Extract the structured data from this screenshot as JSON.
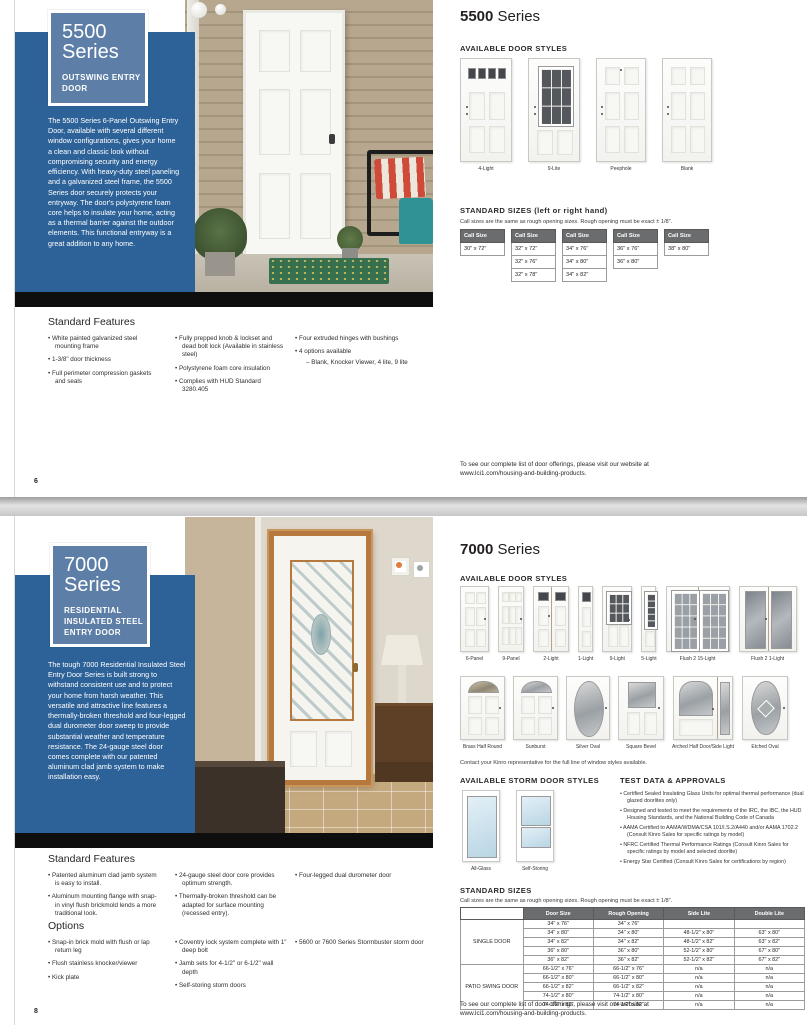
{
  "shared": {
    "footer_line1": "To see our complete list of door offerings, please visit our website at",
    "footer_line2": "www.lci1.com/housing-and-building-products.",
    "call_size_header": "Call Size",
    "colors": {
      "panel_blue": "#2d6298",
      "badge_blue": "#5d7fa7",
      "table_header_gray": "#6b6c6e",
      "bar_black": "#0e0e0e"
    }
  },
  "page1": {
    "page_number": "6",
    "badge": {
      "number": "5500",
      "word": "Series",
      "subtitle": "OUTSWING ENTRY DOOR"
    },
    "intro_text": "The 5500 Series 6-Panel Outswing Entry Door, available with several different window configurations, gives your home a clean and classic look without compromising security and energy efficiency. With heavy-duty steel paneling and a galvanized steel frame, the 5500 Series door securely protects your entryway. The door's polystyrene foam core helps to insulate your home, acting as a thermal barrier against the outdoor elements. This functional entryway is a great addition to any home.",
    "title_bold": "5500",
    "title_word": " Series",
    "door_styles_heading": "AVAILABLE DOOR STYLES",
    "door_styles": [
      {
        "label": "4-Light",
        "kind": "light4"
      },
      {
        "label": "9-Lite",
        "kind": "lite9"
      },
      {
        "label": "Peephole",
        "kind": "peephole"
      },
      {
        "label": "Blank",
        "kind": "blank"
      }
    ],
    "sizes_heading": "STANDARD SIZES (left or right hand)",
    "sizes_note": "Call sizes are the same as rough opening sizes. Rough opening must be exact ± 1/8\".",
    "call_size_tables": [
      {
        "rows": [
          "30\" x 72\""
        ]
      },
      {
        "rows": [
          "32\" x 72\"",
          "32\" x 76\"",
          "32\" x 78\""
        ]
      },
      {
        "rows": [
          "34\" x 76\"",
          "34\" x 80\"",
          "34\" x 82\""
        ]
      },
      {
        "rows": [
          "36\" x 76\"",
          "36\" x 80\""
        ]
      },
      {
        "rows": [
          "38\" x 80\""
        ]
      }
    ],
    "features": {
      "heading": "Standard Features",
      "columns": [
        [
          {
            "text": "White painted galvanized steel mounting frame"
          },
          {
            "text": "1-3/8\" door thickness"
          },
          {
            "text": "Full perimeter compression gaskets and seals"
          }
        ],
        [
          {
            "text": "Fully prepped knob & lockset and dead bolt lock (Available in stainless steel)"
          },
          {
            "text": "Polystyrene foam core insulation"
          },
          {
            "text": "Complies with HUD Standard 3280.405"
          }
        ],
        [
          {
            "text": "Four extruded hinges with bushings"
          },
          {
            "text": "4 options available"
          },
          {
            "text": "Blank, Knocker Viewer, 4 lite, 9 lite",
            "sub": true
          }
        ]
      ]
    }
  },
  "page2": {
    "page_number": "8",
    "badge": {
      "number": "7000",
      "word": "Series",
      "subtitle": "RESIDENTIAL INSULATED STEEL ENTRY DOOR"
    },
    "intro_text": "The tough 7000 Residential Insulated Steel Entry Door Series is built strong to withstand consistent use and to protect your home from harsh weather. This versatile and attractive line features a thermally-broken threshold and four-legged dual durometer door sweep to provide substantial weather and temperature resistance. The 24-gauge steel door comes complete with our patented aluminum clad jamb system to make installation easy.",
    "title_bold": "7000",
    "title_word": " Series",
    "door_styles_heading": "AVAILABLE DOOR STYLES",
    "door_styles_row1": [
      {
        "label": "6-Panel",
        "kind": "p6"
      },
      {
        "label": "9-Panel",
        "kind": "p9"
      },
      {
        "label": "2-Light",
        "kind": "light2"
      },
      {
        "label": "1-Light",
        "kind": "light1"
      },
      {
        "label": "9-Light",
        "kind": "light9"
      },
      {
        "label": "5-Light",
        "kind": "light5"
      },
      {
        "label": "Flush 2 15-Light",
        "kind": "flush15"
      },
      {
        "label": "Flush 2 1-Light",
        "kind": "flush1"
      }
    ],
    "door_styles_row2": [
      {
        "label": "Brass Half Round",
        "kind": "halfround"
      },
      {
        "label": "Sunburst",
        "kind": "sunburst"
      },
      {
        "label": "Silver Oval",
        "kind": "ovalsilver"
      },
      {
        "label": "Square Bevel",
        "kind": "squarebevel"
      },
      {
        "label": "Arched Half Door/Side Light",
        "kind": "archedhalf"
      },
      {
        "label": "Etched Oval",
        "kind": "etchedoval"
      }
    ],
    "styles_note": "Contact your Kinro representative for the full line of window styles available.",
    "storm_heading": "AVAILABLE STORM DOOR STYLES",
    "storm_styles": [
      {
        "label": "All-Glass",
        "kind": "allglass"
      },
      {
        "label": "Self-Storing",
        "kind": "selfstoring"
      }
    ],
    "test_data": {
      "heading": "TEST DATA & APPROVALS",
      "bullets": [
        "Certified Sealed Insulating Glass Units for optimal thermal performance (dual glazed doorlites only)",
        "Designed and tested to meet the requirements of the IRC, the IBC, the HUD Housing Standards, and the National Building Code of Canada",
        "AAMA Certified to AAMA/WDMA/CSA 101/I.S.2/A440 and/or AAMA 1702.2 (Consult Kinro Sales for specific ratings by model)",
        "NFRC Certified Thermal Performance Ratings (Consult Kinro Sales for specific ratings by model and selected doorlite)",
        "Energy Star Certified (Consult Kinro Sales for certifications by region)"
      ]
    },
    "sizes_heading": "STANDARD SIZES",
    "sizes_note": "Call sizes are the same as rough opening sizes. Rough opening must be exact ± 1/8\".",
    "sizes_table": {
      "columns": [
        "Door Size",
        "Rough Opening",
        "Side Lite",
        "Double Lite"
      ],
      "groups": [
        {
          "label": "SINGLE DOOR",
          "rows": [
            [
              "34\" x 76\"",
              "34\" x 76\"",
              "",
              ""
            ],
            [
              "34\" x 80\"",
              "34\" x 80\"",
              "48-1/2\" x 80\"",
              "63\" x 80\""
            ],
            [
              "34\" x 82\"",
              "34\" x 82\"",
              "48-1/2\" x 82\"",
              "63\" x 82\""
            ],
            [
              "36\" x 80\"",
              "36\" x 80\"",
              "52-1/2\" x 80\"",
              "67\" x 80\""
            ],
            [
              "36\" x 82\"",
              "36\" x 82\"",
              "52-1/2\" x 82\"",
              "67\" x 82\""
            ]
          ]
        },
        {
          "label": "PATIO SWING DOOR",
          "rows": [
            [
              "66-1/2\" x 76\"",
              "66-1/2\" x 76\"",
              "n/a",
              "n/a"
            ],
            [
              "66-1/2\" x 80\"",
              "66-1/2\" x 80\"",
              "n/a",
              "n/a"
            ],
            [
              "66-1/2\" x 82\"",
              "66-1/2\" x 82\"",
              "n/a",
              "n/a"
            ],
            [
              "74-1/2\" x 80\"",
              "74-1/2\" x 80\"",
              "n/a",
              "n/a"
            ],
            [
              "74-1/2\" x 82\"",
              "74-1/2\" x 82\"",
              "n/a",
              "n/a"
            ]
          ]
        }
      ]
    },
    "features": {
      "heading": "Standard Features",
      "columns": [
        [
          {
            "text": "Patented aluminum clad jamb system is easy to install."
          },
          {
            "text": "Aluminum mounting flange with snap-in vinyl flush brickmold lends a more traditional look."
          }
        ],
        [
          {
            "text": "24-gauge steel door core provides optimum strength."
          },
          {
            "text": "Thermally-broken threshold can be adapted for surface mounting (recessed entry)."
          }
        ],
        [
          {
            "text": "Four-legged dual durometer door"
          }
        ]
      ]
    },
    "options": {
      "heading": "Options",
      "columns": [
        [
          {
            "text": "Snap-in brick mold with flush or lap return leg"
          },
          {
            "text": "Flush stainless knocker/viewer"
          },
          {
            "text": "Kick plate"
          }
        ],
        [
          {
            "text": "Coventry lock system complete with 1\" deep bolt"
          },
          {
            "text": "Jamb sets for 4-1/2\" or 6-1/2\" wall depth"
          },
          {
            "text": "Self-storing storm doors"
          }
        ],
        [
          {
            "text": "5600 or 7600 Series Stormbuster storm door"
          }
        ]
      ]
    }
  }
}
